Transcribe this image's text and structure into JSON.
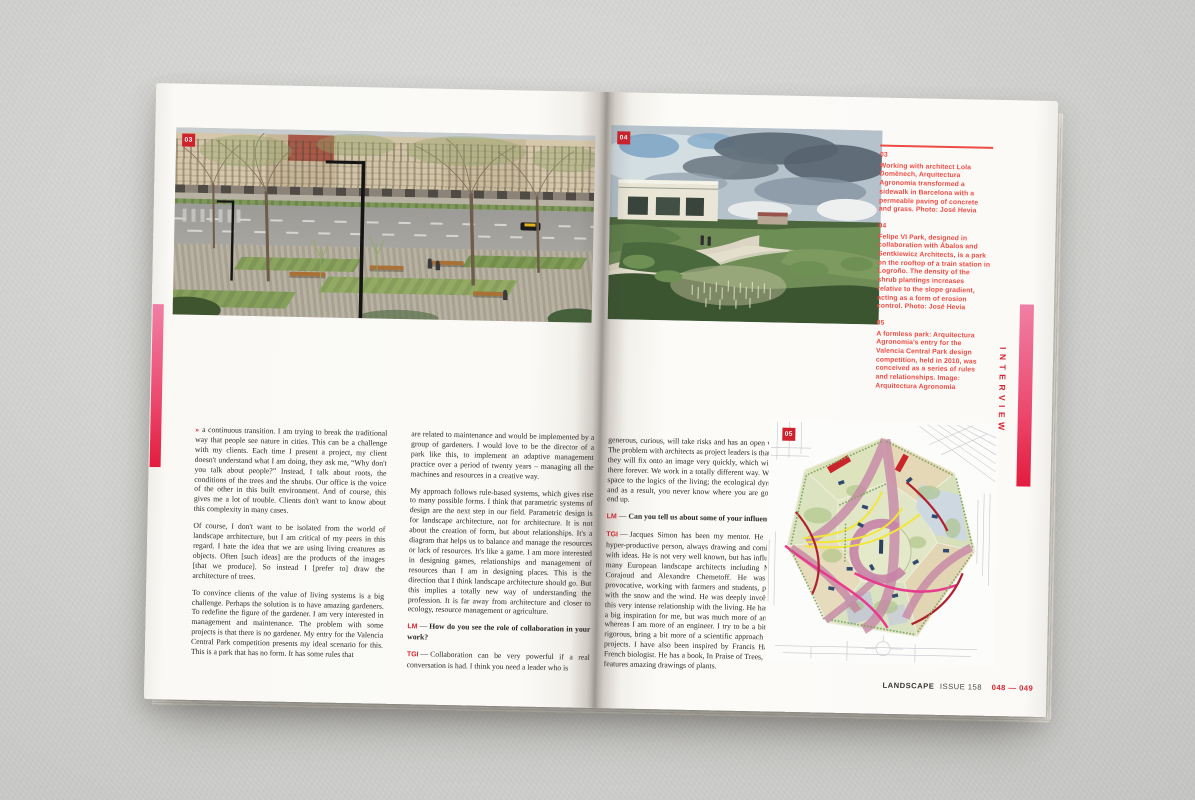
{
  "colors": {
    "accent_red": "#d92531",
    "caption_red": "#ee4b44",
    "badge_red": "#d0222d",
    "pink_top": "#f07fa5",
    "pink_bottom": "#e31c3e"
  },
  "magazine": {
    "section_label": "INTERVIEW",
    "footer": {
      "brand": "LANDSCAPE",
      "issue": "ISSUE 158",
      "pages": "048 — 049"
    }
  },
  "captions": [
    {
      "number": "03",
      "text": "Working with architect Lola Domènech, Arquitectura Agronomia transformed a sidewalk in Barcelona with a permeable paving of concrete and grass. Photo: José Hevia"
    },
    {
      "number": "04",
      "text": "Felipe VI Park, designed in collaboration with Ábalos and Sentkiewicz Architects, is a park on the rooftop of a train station in Logroño. The density of the shrub plantings increases relative to the slope gradient, acting as a form of erosion control. Photo: José Hevia"
    },
    {
      "number": "05",
      "text": "A formless park: Arquitectura Agronomia's entry for the Valencia Central Park design competition, held in 2010, was conceived as a series of rules and relationships. Image: Arquitectura Agronomia"
    }
  ],
  "article": {
    "continuation_mark": "»",
    "dash": "—",
    "col1": [
      {
        "type": "para",
        "text": "a continuous transition. I am trying to break the traditional way that people see nature in cities. This can be a challenge with my clients. Each time I present a project, my client doesn't understand what I am doing, they ask me, “Why don't you talk about people?” Instead, I talk about roots, the conditions of the trees and the shrubs. Our office is the voice of the other in this built environment. And of course, this gives me a lot of trouble. Clients don't want to know about this complexity in many cases."
      },
      {
        "type": "para",
        "text": "Of course, I don't want to be isolated from the world of landscape architecture, but I am critical of my peers in this regard. I hate the idea that we are using living creatures as objects. Often [such ideas] are the products of the images [that we produce]. So instead I [prefer to] draw the architecture of trees."
      },
      {
        "type": "para",
        "text": "To convince clients of the value of living systems is a big challenge. Perhaps the solution is to have amazing gardeners. To redefine the figure of the gardener. I am very interested in management and maintenance. The problem with some projects is that there is no gardener. My entry for the Valencia Central Park competition presents my ideal scenario for this. This is a park that has no form. It has some rules that"
      }
    ],
    "col2": [
      {
        "type": "para",
        "text": "are related to maintenance and would be implemented by a group of gardeners. I would love to be the director of a park like this, to implement an adaptive management practice over a period of twenty years – managing all the machines and resources in a creative way."
      },
      {
        "type": "para",
        "text": "My approach follows rule-based systems, which gives rise to many possible forms. I think that parametric systems of design are the next step in our field. Parametric design is for landscape architecture, not for architecture. It is not about the creation of form, but about relationships. It's a diagram that helps us to balance and manage the resources or lack of resources. It's like a game. I am more interested in designing games, relationships and management of resources than I am in designing places. This is the direction that I think landscape architecture should go. But this implies a totally new way of understanding the profession. It is far away from architecture and closer to ecology, resource management or agriculture."
      },
      {
        "type": "question",
        "speaker": "LM",
        "text": "How do you see the role of collaboration in your work?"
      },
      {
        "type": "answer",
        "speaker": "TGI",
        "text": "Collaboration can be very powerful if a real conversation is had. I think you need a leader who is"
      }
    ],
    "col3": [
      {
        "type": "para",
        "text": "generous, curious, will take risks and has an open vision. The problem with architects as project leaders is that often they will fix onto an image very quickly, which will stay there forever. We work in a totally different way. We give space to the logics of the living; the ecological dynamics and as a result, you never know where you are going to end up."
      },
      {
        "type": "question",
        "speaker": "LM",
        "text": "Can you tell us about some of your influences?"
      },
      {
        "type": "answer",
        "speaker": "TGI",
        "text": "Jacques Simon has been my mentor. He was a hyper-productive person, always drawing and coming up with ideas. He is not very well known, but has influenced many European landscape architects including Michel Corajoud and Alexandre Chemetoff. He was very provocative, working with farmers and students, playing with the snow and the wind. He was deeply involved in this very intense relationship with the living. He has been a big inspiration for me, but was much more of an artist whereas I am more of an engineer. I try to be a bit more rigorous, bring a bit more of a scientific approach to my projects. I have also been inspired by Francis Hallé, a French biologist. He has a book, In Praise of Trees, which features amazing drawings of plants."
      }
    ]
  }
}
